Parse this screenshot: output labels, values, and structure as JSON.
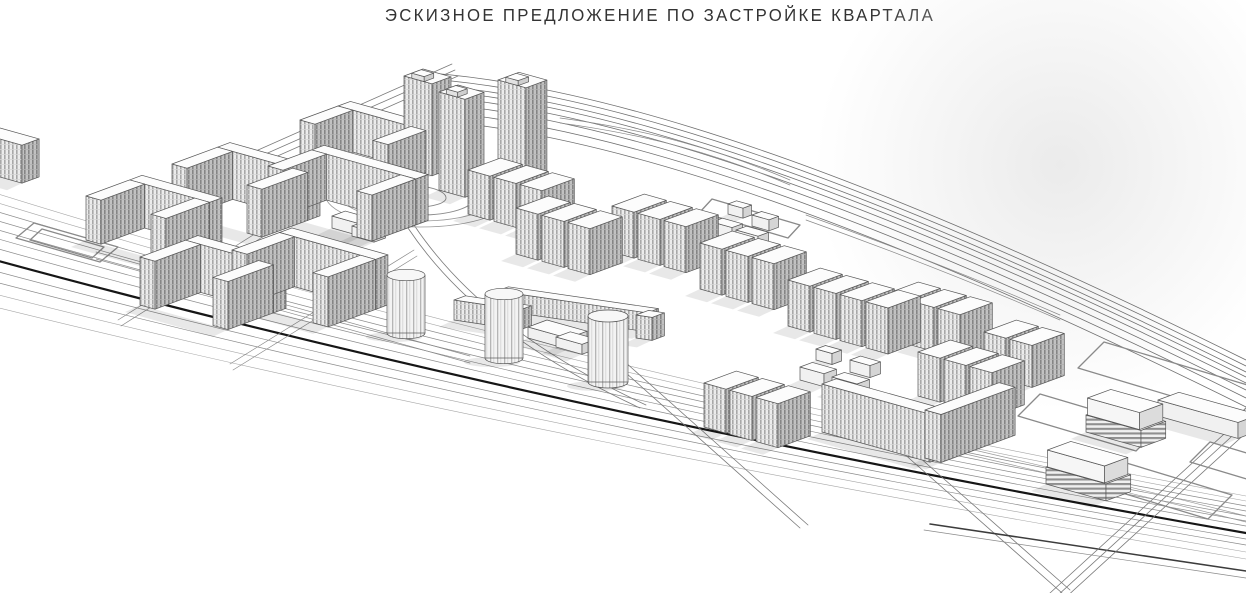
{
  "sheet": {
    "title": "ЭСКИЗНОЕ ПРЕДЛОЖЕНИЕ ПО ЗАСТРОЙКЕ КВАРТАЛА"
  },
  "palette": {
    "background": "#ffffff",
    "line": "#565656",
    "line_dark": "#161616",
    "facade_front": "#ececec",
    "facade_side": "#c2c2c2",
    "window_stripe": "#a8a8a8",
    "roof": "#fcfcfc",
    "shadow": "rgba(0,0,0,0.09)",
    "title_color": "#333333"
  },
  "scene": {
    "features": [
      "perimeter-apartment-blocks",
      "echelon-apartment-rows",
      "point-towers",
      "round-towers",
      "school-building",
      "kindergarten-clusters",
      "multilevel-parking-garages",
      "main-boulevard",
      "arterial-road",
      "roundabout-spiral-lawn",
      "vacant-parcels",
      "surface-parking-lot"
    ],
    "roads": [
      {
        "name": "boulevard-lane",
        "d": "M -5,193 C 380,313 800,413 1246,496",
        "w": 0.6,
        "c": "#a6a6a6"
      },
      {
        "name": "boulevard-lane",
        "d": "M -5,202 C 380,320 800,419 1246,501",
        "w": 0.6,
        "c": "#a6a6a6"
      },
      {
        "name": "boulevard-lane",
        "d": "M -5,211 C 380,327 800,425 1246,506",
        "w": 0.7,
        "c": "#8a8a8a"
      },
      {
        "name": "boulevard-lane",
        "d": "M -5,220 C 380,334 800,430 1246,511",
        "w": 0.7,
        "c": "#8a8a8a"
      },
      {
        "name": "boulevard-lane",
        "d": "M -5,229 C 380,341 800,436 1246,516",
        "w": 0.7,
        "c": "#8a8a8a"
      },
      {
        "name": "boulevard-lane",
        "d": "M -5,238 C 380,348 800,441 1246,521",
        "w": 0.7,
        "c": "#8a8a8a"
      },
      {
        "name": "boulevard-lane",
        "d": "M -5,248 C 380,356 800,448 1246,526",
        "w": 0.7,
        "c": "#8a8a8a"
      },
      {
        "name": "boulevard-median",
        "d": "M -5,260 C 380,365 800,455 1246,533",
        "w": 2.2,
        "c": "#161616"
      },
      {
        "name": "boulevard-lane",
        "d": "M -5,271 C 380,374 800,462 1246,539",
        "w": 0.7,
        "c": "#8a8a8a"
      },
      {
        "name": "boulevard-lane",
        "d": "M -5,282 C 380,382 800,469 1246,545",
        "w": 0.7,
        "c": "#8a8a8a"
      },
      {
        "name": "boulevard-lane",
        "d": "M -5,294 C 380,392 800,476 1246,552",
        "w": 0.6,
        "c": "#a6a6a6"
      },
      {
        "name": "boulevard-lane",
        "d": "M -5,307 C 380,402 800,484 1246,559",
        "w": 0.6,
        "c": "#a6a6a6"
      },
      {
        "name": "site-edge-road",
        "d": "M 240,158 L 452,64",
        "w": 0.8,
        "c": "#7a7a7a",
        "copies": [
          [
            0,
            0
          ],
          [
            3,
            6
          ],
          [
            6,
            12
          ]
        ]
      },
      {
        "name": "arterial-road",
        "d": "M 430,85 C 620,100 880,190 1246,372",
        "w": 0.8,
        "c": "#6f6f6f",
        "copies": [
          [
            0,
            -12
          ],
          [
            0,
            -6
          ],
          [
            0,
            0
          ],
          [
            0,
            5
          ],
          [
            0,
            11
          ],
          [
            0,
            18
          ],
          [
            0,
            26
          ],
          [
            0,
            35
          ]
        ]
      },
      {
        "name": "arterial-ramp",
        "d": "M 560,118 C 650,130 720,150 790,180",
        "w": 0.7,
        "c": "#8a8a8a",
        "copies": [
          [
            0,
            0
          ],
          [
            0,
            5
          ]
        ]
      },
      {
        "name": "arterial-ramp",
        "d": "M 806,215 C 890,245 975,278 1060,315",
        "w": 0.7,
        "c": "#8a8a8a",
        "copies": [
          [
            0,
            0
          ],
          [
            0,
            5
          ]
        ]
      },
      {
        "name": "internal-drive",
        "d": "M 408,228 C 452,294 524,354 640,408",
        "w": 0.8,
        "c": "#7a7a7a",
        "copies": [
          [
            0,
            0
          ],
          [
            6,
            -3
          ]
        ]
      },
      {
        "name": "internal-street",
        "d": "M 118,320 L 296,208",
        "w": 0.7,
        "c": "#8a8a8a",
        "copies": [
          [
            0,
            0
          ],
          [
            3,
            6
          ]
        ]
      },
      {
        "name": "internal-street",
        "d": "M 230,364 L 414,250",
        "w": 0.7,
        "c": "#8a8a8a",
        "copies": [
          [
            0,
            0
          ],
          [
            3,
            6
          ]
        ]
      },
      {
        "name": "internal-street",
        "d": "M 96,252 L 470,356",
        "w": 0.7,
        "c": "#8a8a8a",
        "copies": [
          [
            0,
            0
          ],
          [
            0,
            7
          ]
        ]
      },
      {
        "name": "cross-street",
        "d": "M 598,348 L 800,528",
        "w": 0.8,
        "c": "#7a7a7a",
        "copies": [
          [
            0,
            0
          ],
          [
            8,
            -3
          ]
        ]
      },
      {
        "name": "cross-street",
        "d": "M 902,452 L 1062,593",
        "w": 0.8,
        "c": "#7a7a7a",
        "copies": [
          [
            0,
            0
          ],
          [
            8,
            -3
          ]
        ]
      },
      {
        "name": "south-street",
        "d": "M 930,524 L 1246,571",
        "w": 1.5,
        "c": "#3c3c3c"
      },
      {
        "name": "south-street",
        "d": "M 924,530 L 1246,578",
        "w": 0.7,
        "c": "#8a8a8a"
      },
      {
        "name": "east-street",
        "d": "M 1246,414 L 1050,593",
        "w": 0.8,
        "c": "#7a7a7a",
        "copies": [
          [
            0,
            0
          ],
          [
            7,
            3
          ],
          [
            14,
            6
          ]
        ]
      },
      {
        "name": "east-street",
        "d": "M 896,432 C 1010,458 1120,484 1246,516",
        "w": 0.7,
        "c": "#9a9a9a",
        "copies": [
          [
            0,
            0
          ],
          [
            0,
            6
          ]
        ]
      }
    ],
    "parcels": [
      {
        "name": "vacant-parcel",
        "d": "M 1078,368 L 1238,416 L 1264,390 L 1104,342 Z"
      },
      {
        "name": "vacant-parcel",
        "d": "M 1018,416 L 1136,451 L 1158,429 L 1040,394 Z"
      },
      {
        "name": "vacant-parcel",
        "d": "M 1066,476 L 1208,519 L 1232,495 L 1090,452 Z"
      },
      {
        "name": "vacant-parcel",
        "d": "M 1190,462 L 1260,483 L 1280,463 L 1210,442 Z"
      },
      {
        "name": "parking-lot",
        "d": "M 16,238 L 100,262 L 118,247 L 34,223 Z"
      },
      {
        "name": "parking-lot-inner",
        "d": "M 30,240 L 92,258 L 104,247 L 42,229 Z"
      },
      {
        "name": "kindergarten-loop",
        "d": "M 700,212 L 788,238 L 800,225 L 712,199 Z"
      }
    ],
    "roundabout": {
      "rings": [
        [
          420,
          194,
          95,
          33
        ],
        [
          420,
          194,
          80,
          27
        ]
      ],
      "spiral": "M 474,198 A 54,17 0 0 1 366,198 A 40,13 0 0 1 446,198 A 28,9 0 0 1 390,198 A 16,5 0 0 1 422,198"
    },
    "buildings": [
      {
        "type": "slab",
        "name": "edge-apartment-slab",
        "x": -18,
        "y": 172,
        "la": 40,
        "lb": 18,
        "h": 38
      },
      {
        "type": "ublock",
        "name": "perimeter-block",
        "x": 86,
        "y": 240,
        "w": 80,
        "wing": 46,
        "h": 44
      },
      {
        "type": "ublock",
        "name": "perimeter-block",
        "x": 172,
        "y": 212,
        "w": 90,
        "wing": 48,
        "h": 48
      },
      {
        "type": "ublock",
        "name": "perimeter-block",
        "x": 140,
        "y": 305,
        "w": 88,
        "wing": 48,
        "h": 48
      },
      {
        "type": "ublock",
        "name": "perimeter-block",
        "x": 232,
        "y": 300,
        "w": 96,
        "wing": 50,
        "h": 50
      },
      {
        "type": "ublock",
        "name": "perimeter-block",
        "x": 268,
        "y": 212,
        "w": 104,
        "wing": 46,
        "h": 46
      },
      {
        "type": "ublock",
        "name": "perimeter-block",
        "x": 300,
        "y": 162,
        "w": 88,
        "wing": 40,
        "h": 42
      },
      {
        "type": "tower",
        "name": "point-tower",
        "x": 404,
        "y": 168,
        "la": 28,
        "lb": 20,
        "h": 92
      },
      {
        "type": "tower",
        "name": "point-tower",
        "x": 439,
        "y": 190,
        "la": 26,
        "lb": 20,
        "h": 98
      },
      {
        "type": "tower",
        "name": "point-tower",
        "x": 498,
        "y": 172,
        "la": 28,
        "lb": 22,
        "h": 92
      },
      {
        "type": "row",
        "name": "apartment-row",
        "x": 468,
        "y": 214,
        "n": 3,
        "h": 44
      },
      {
        "type": "row",
        "name": "apartment-row",
        "x": 516,
        "y": 254,
        "n": 3,
        "h": 46
      },
      {
        "type": "row",
        "name": "apartment-row",
        "x": 612,
        "y": 252,
        "n": 3,
        "h": 46
      },
      {
        "type": "row",
        "name": "apartment-row",
        "x": 700,
        "y": 289,
        "n": 3,
        "h": 46
      },
      {
        "type": "row",
        "name": "apartment-row",
        "x": 788,
        "y": 326,
        "n": 4,
        "h": 46
      },
      {
        "type": "row",
        "name": "apartment-row",
        "x": 886,
        "y": 338,
        "n": 3,
        "h": 44
      },
      {
        "type": "row",
        "name": "apartment-row",
        "x": 918,
        "y": 396,
        "n": 3,
        "h": 44
      },
      {
        "type": "row",
        "name": "apartment-row",
        "x": 984,
        "y": 374,
        "n": 2,
        "h": 42
      },
      {
        "type": "row",
        "name": "apartment-row",
        "x": 704,
        "y": 427,
        "n": 3,
        "h": 44
      },
      {
        "type": "slab",
        "name": "corner-block-wing",
        "x": 822,
        "y": 432,
        "la": 108,
        "lb": 15,
        "h": 48
      },
      {
        "type": "slab",
        "name": "corner-block-wing",
        "x": 925,
        "y": 458,
        "la": 16,
        "lb": 78,
        "h": 48
      },
      {
        "type": "slab",
        "name": "school-wing",
        "x": 454,
        "y": 320,
        "la": 66,
        "lb": 12,
        "h": 20,
        "uy": 0.15
      },
      {
        "type": "slab",
        "name": "school-wing",
        "x": 497,
        "y": 310,
        "la": 150,
        "lb": 12,
        "h": 19,
        "uy": 0.145
      },
      {
        "type": "slab",
        "name": "school-wing",
        "x": 636,
        "y": 338,
        "la": 16,
        "lb": 13,
        "h": 23,
        "uy": 0.15
      },
      {
        "type": "low",
        "name": "school-hall",
        "x": 528,
        "y": 338,
        "la": 40,
        "lb": 20,
        "h": 11
      },
      {
        "type": "low",
        "name": "school-hall",
        "x": 556,
        "y": 347,
        "la": 26,
        "lb": 15,
        "h": 10
      },
      {
        "type": "low",
        "name": "club-building",
        "x": 332,
        "y": 228,
        "la": 30,
        "lb": 14,
        "h": 12
      },
      {
        "type": "low",
        "name": "club-building",
        "x": 352,
        "y": 236,
        "la": 22,
        "lb": 12,
        "h": 10
      },
      {
        "type": "cyl",
        "name": "round-tower",
        "cx": 406,
        "base": 333,
        "r": 19,
        "h": 58
      },
      {
        "type": "cyl",
        "name": "round-tower",
        "cx": 504,
        "base": 358,
        "r": 19,
        "h": 64
      },
      {
        "type": "cyl",
        "name": "round-tower",
        "cx": 608,
        "base": 382,
        "r": 20,
        "h": 66
      },
      {
        "type": "low",
        "name": "kindergarten",
        "x": 712,
        "y": 234,
        "la": 20,
        "lb": 11,
        "h": 12
      },
      {
        "type": "low",
        "name": "kindergarten",
        "x": 736,
        "y": 242,
        "la": 22,
        "lb": 11,
        "h": 12
      },
      {
        "type": "low",
        "name": "kindergarten",
        "x": 752,
        "y": 226,
        "la": 17,
        "lb": 10,
        "h": 11
      },
      {
        "type": "low",
        "name": "kindergarten",
        "x": 728,
        "y": 214,
        "la": 15,
        "lb": 9,
        "h": 10
      },
      {
        "type": "low",
        "name": "kindergarten",
        "x": 800,
        "y": 380,
        "la": 24,
        "lb": 13,
        "h": 13
      },
      {
        "type": "low",
        "name": "kindergarten",
        "x": 832,
        "y": 390,
        "la": 25,
        "lb": 13,
        "h": 13
      },
      {
        "type": "low",
        "name": "kindergarten",
        "x": 850,
        "y": 372,
        "la": 20,
        "lb": 11,
        "h": 12
      },
      {
        "type": "low",
        "name": "kindergarten",
        "x": 816,
        "y": 360,
        "la": 16,
        "lb": 10,
        "h": 11
      },
      {
        "type": "garage",
        "name": "parking-garage",
        "x": 1086,
        "y": 432,
        "la": 55,
        "lb": 26,
        "h": 34
      },
      {
        "type": "garage",
        "name": "parking-garage",
        "x": 1046,
        "y": 484,
        "la": 60,
        "lb": 26,
        "h": 34
      },
      {
        "type": "low",
        "name": "low-building",
        "x": 1158,
        "y": 416,
        "la": 80,
        "lb": 22,
        "h": 16
      }
    ]
  }
}
